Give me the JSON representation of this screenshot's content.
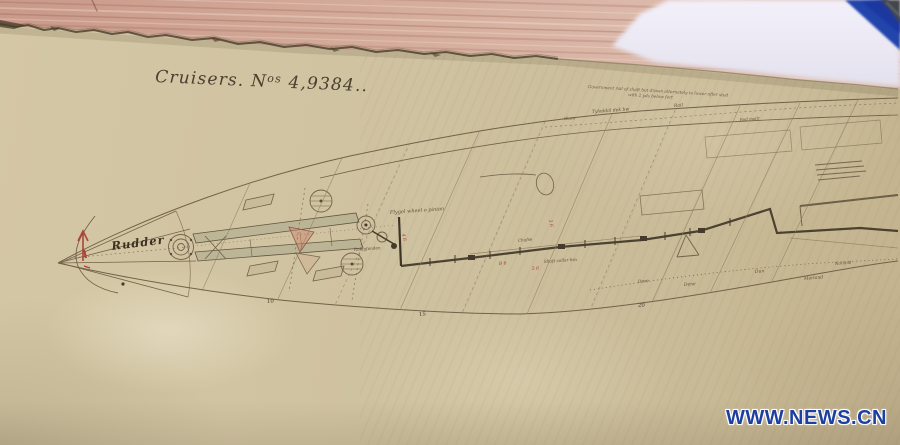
{
  "photo": {
    "watermark": "WWW.NEWS.CN"
  },
  "colors": {
    "watermark_blue": "#1c3fa0",
    "paper_tan": "#cfc2a0",
    "wood_pink": "#d0a492",
    "ink_brown": "#5a4b36",
    "red_ink": "#a8392f",
    "white_sheet": "#efecf6",
    "blue_object": "#2444ac"
  },
  "document": {
    "title_pre": "Cruisers. N",
    "title_sup": "os",
    "title_post": " 4,9384..",
    "rudder_label": "Rudder",
    "top_note_line1": "Government rail of shaft but drawn alternately to lower after stud",
    "top_note_line2": "with 2 yds below fort",
    "station_numbers": [
      "10",
      "15",
      "20"
    ],
    "annotations": [
      "Flygel wheel o pinion",
      "Rolagfenden",
      "Chafse",
      "Shaft collar box",
      "Dore",
      "Dene",
      "Dun",
      "Morland",
      "Norland",
      "Tyladdal dek bw",
      "Rail",
      "Glace",
      "Rod mollr"
    ],
    "red_marks": [
      "4 6",
      "3 6",
      "B 6",
      "5 6"
    ]
  }
}
